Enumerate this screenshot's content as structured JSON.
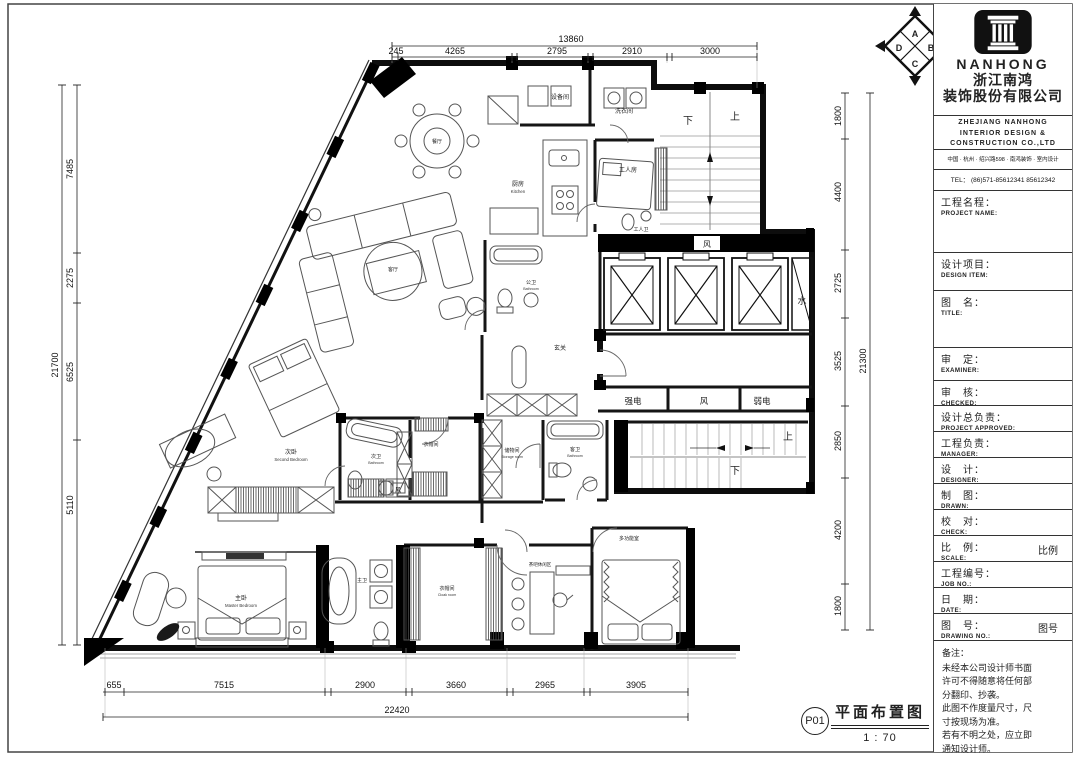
{
  "sheet": {
    "brand": {
      "name_en": "NANHONG",
      "name_zh_1": "浙江南鸿",
      "name_zh_2": "装饰股份有限公司",
      "en_line1": "ZHEJIANG NANHONG",
      "en_line2": "INTERIOR DESIGN &",
      "en_line3": "CONSTRUCTION CO.,LTD",
      "address": "中国 · 杭州 · 绍兴路598 · 南鸿装饰 · 室内设计",
      "tel": "TEL： (86)571-85612341  85612342"
    },
    "fields": [
      {
        "zh": "工程名程：",
        "en": "PROJECT NAME:",
        "h": 62
      },
      {
        "zh": "设计项目：",
        "en": "DESIGN ITEM:",
        "h": 38
      },
      {
        "zh": "图　名：",
        "en": "TITLE:",
        "h": 57
      },
      {
        "zh": "审　定：",
        "en": "EXAMINER:",
        "h": 33
      },
      {
        "zh": "审　核：",
        "en": "CHECKED:",
        "h": 25
      },
      {
        "zh": "设计总负责：",
        "en": "PROJECT APPROVED:",
        "h": 26
      },
      {
        "zh": "工程负责：",
        "en": "MANAGER:",
        "h": 26
      },
      {
        "zh": "设　计：",
        "en": "DESIGNER:",
        "h": 26
      },
      {
        "zh": "制　图：",
        "en": "DRAWN:",
        "h": 26
      },
      {
        "zh": "校　对：",
        "en": "CHECK:",
        "h": 26
      },
      {
        "zh": "比　例：",
        "en": "SCALE:",
        "value": "比例",
        "h": 26
      },
      {
        "zh": "工程编号：",
        "en": "JOB NO.:",
        "h": 26
      },
      {
        "zh": "日　期：",
        "en": "DATE:",
        "h": 26
      },
      {
        "zh": "图　号：",
        "en": "DRAWING NO.:",
        "value": "图号",
        "h": 27
      }
    ],
    "notes_title": "备注：",
    "notes": [
      "未经本公司设计师书面",
      "许可不得随意将任何部",
      "分翻印、抄袭。",
      "此图不作度量尺寸，尺",
      "寸按现场为准。",
      "若有不明之处，应立即",
      "通知设计师。"
    ]
  },
  "plan": {
    "title": "平面布置图",
    "sheet_no": "P01",
    "scale": "1 : 70",
    "labels": [
      {
        "t": "餐厅",
        "x": 437,
        "y": 143,
        "s": 5
      },
      {
        "t": "客厅",
        "x": 393,
        "y": 271,
        "s": 5
      },
      {
        "t": "设备间",
        "x": 560,
        "y": 99,
        "s": 6
      },
      {
        "t": "洗衣间",
        "x": 624,
        "y": 113,
        "s": 6
      },
      {
        "t": "厨房",
        "e": "Kitchen",
        "x": 518,
        "y": 186,
        "s": 6
      },
      {
        "t": "工人房",
        "x": 628,
        "y": 172,
        "s": 6
      },
      {
        "t": "工人卫",
        "x": 641,
        "y": 231,
        "s": 5
      },
      {
        "t": "公卫",
        "e": "Bathroom",
        "x": 531,
        "y": 284,
        "s": 5
      },
      {
        "t": "玄关",
        "x": 560,
        "y": 350,
        "s": 6
      },
      {
        "t": "次卧",
        "e": "Second Bedroom",
        "x": 291,
        "y": 454,
        "s": 6
      },
      {
        "t": "次卫",
        "e": "Bathroom",
        "x": 376,
        "y": 458,
        "s": 5
      },
      {
        "t": "衣帽间",
        "x": 431,
        "y": 446,
        "s": 5
      },
      {
        "t": "储物间",
        "e": "Storage room",
        "x": 512,
        "y": 452,
        "s": 5
      },
      {
        "t": "客卫",
        "e": "Bathroom",
        "x": 575,
        "y": 451,
        "s": 5
      },
      {
        "t": "主卧",
        "e": "Master Bedroom",
        "x": 241,
        "y": 600,
        "s": 6
      },
      {
        "t": "主卫",
        "x": 362,
        "y": 582,
        "s": 5
      },
      {
        "t": "衣帽间",
        "e": "Cloak room",
        "x": 447,
        "y": 590,
        "s": 5
      },
      {
        "t": "茶吧休闲区",
        "x": 540,
        "y": 566,
        "s": 4.5
      },
      {
        "t": "多功能室",
        "x": 629,
        "y": 540,
        "s": 5
      },
      {
        "t": "强电",
        "x": 633,
        "y": 404,
        "s": 8.5
      },
      {
        "t": "风",
        "x": 704,
        "y": 404,
        "s": 8.5
      },
      {
        "t": "弱电",
        "x": 762,
        "y": 404,
        "s": 8.5
      },
      {
        "t": "风",
        "x": 707,
        "y": 247,
        "s": 8
      },
      {
        "t": "水",
        "x": 802,
        "y": 304,
        "s": 9
      },
      {
        "t": "下",
        "x": 688,
        "y": 124,
        "s": 10
      },
      {
        "t": "上",
        "x": 735,
        "y": 120,
        "s": 10
      },
      {
        "t": "上",
        "x": 788,
        "y": 440,
        "s": 10
      },
      {
        "t": "下",
        "x": 735,
        "y": 474,
        "s": 10
      },
      {
        "t": "风",
        "x": 398,
        "y": 492,
        "s": 6
      },
      {
        "t": "A",
        "x": 915,
        "y": 37,
        "s": 9,
        "b": 1
      },
      {
        "t": "D",
        "x": 899,
        "y": 51,
        "s": 9,
        "b": 1
      },
      {
        "t": "B",
        "x": 931,
        "y": 51,
        "s": 9,
        "b": 1
      },
      {
        "t": "C",
        "x": 915,
        "y": 67,
        "s": 9,
        "b": 1
      }
    ],
    "dims": {
      "h": [
        {
          "y": 46,
          "x1": 392,
          "x2": 757,
          "ticks": [
            392,
            757
          ],
          "ly": 42,
          "labels": [
            {
              "v": "13860",
              "x": 571
            }
          ]
        },
        {
          "y": 57,
          "x1": 392,
          "x2": 757,
          "ticks": [
            392,
            398,
            512,
            517,
            588,
            593,
            667,
            672,
            757
          ],
          "ly": 54,
          "labels": [
            {
              "v": "245",
              "x": 396
            },
            {
              "v": "4265",
              "x": 455
            },
            {
              "v": "2795",
              "x": 557
            },
            {
              "v": "2910",
              "x": 632
            },
            {
              "v": "3000",
              "x": 710
            }
          ]
        },
        {
          "y": 692,
          "x1": 103,
          "x2": 688,
          "ticks": [
            105,
            124,
            325,
            331,
            406,
            412,
            507,
            513,
            584,
            590,
            688
          ],
          "ly": 688,
          "labels": [
            {
              "v": "655",
              "x": 114
            },
            {
              "v": "7515",
              "x": 224
            },
            {
              "v": "2900",
              "x": 365
            },
            {
              "v": "3660",
              "x": 456
            },
            {
              "v": "2965",
              "x": 545
            },
            {
              "v": "3905",
              "x": 636
            }
          ]
        },
        {
          "y": 717,
          "x1": 103,
          "x2": 688,
          "ticks": [
            103,
            688
          ],
          "ly": 713,
          "labels": [
            {
              "v": "22420",
              "x": 397
            }
          ]
        }
      ],
      "v": [
        {
          "x": 62,
          "y1": 85,
          "y2": 645,
          "ticks": [
            85,
            645
          ],
          "lx": 58,
          "labels": [
            {
              "v": "21700",
              "y": 365
            }
          ]
        },
        {
          "x": 77,
          "y1": 85,
          "y2": 645,
          "ticks": [
            85,
            253,
            303,
            440,
            645
          ],
          "lx": 73,
          "labels": [
            {
              "v": "7485",
              "y": 169
            },
            {
              "v": "2275",
              "y": 278
            },
            {
              "v": "6525",
              "y": 372
            },
            {
              "v": "5110",
              "y": 505
            }
          ]
        },
        {
          "x": 845,
          "y1": 93,
          "y2": 630,
          "ticks": [
            93,
            139,
            250,
            318,
            406,
            478,
            584,
            630
          ],
          "lx": 841,
          "labels": [
            {
              "v": "1800",
              "y": 116
            },
            {
              "v": "4400",
              "y": 192
            },
            {
              "v": "2725",
              "y": 283
            },
            {
              "v": "3525",
              "y": 361
            },
            {
              "v": "2850",
              "y": 441
            },
            {
              "v": "4200",
              "y": 530
            },
            {
              "v": "1800",
              "y": 606
            }
          ]
        },
        {
          "x": 870,
          "y1": 93,
          "y2": 630,
          "ticks": [
            93,
            630
          ],
          "lx": 866,
          "labels": [
            {
              "v": "21300",
              "y": 361
            }
          ]
        }
      ]
    }
  }
}
